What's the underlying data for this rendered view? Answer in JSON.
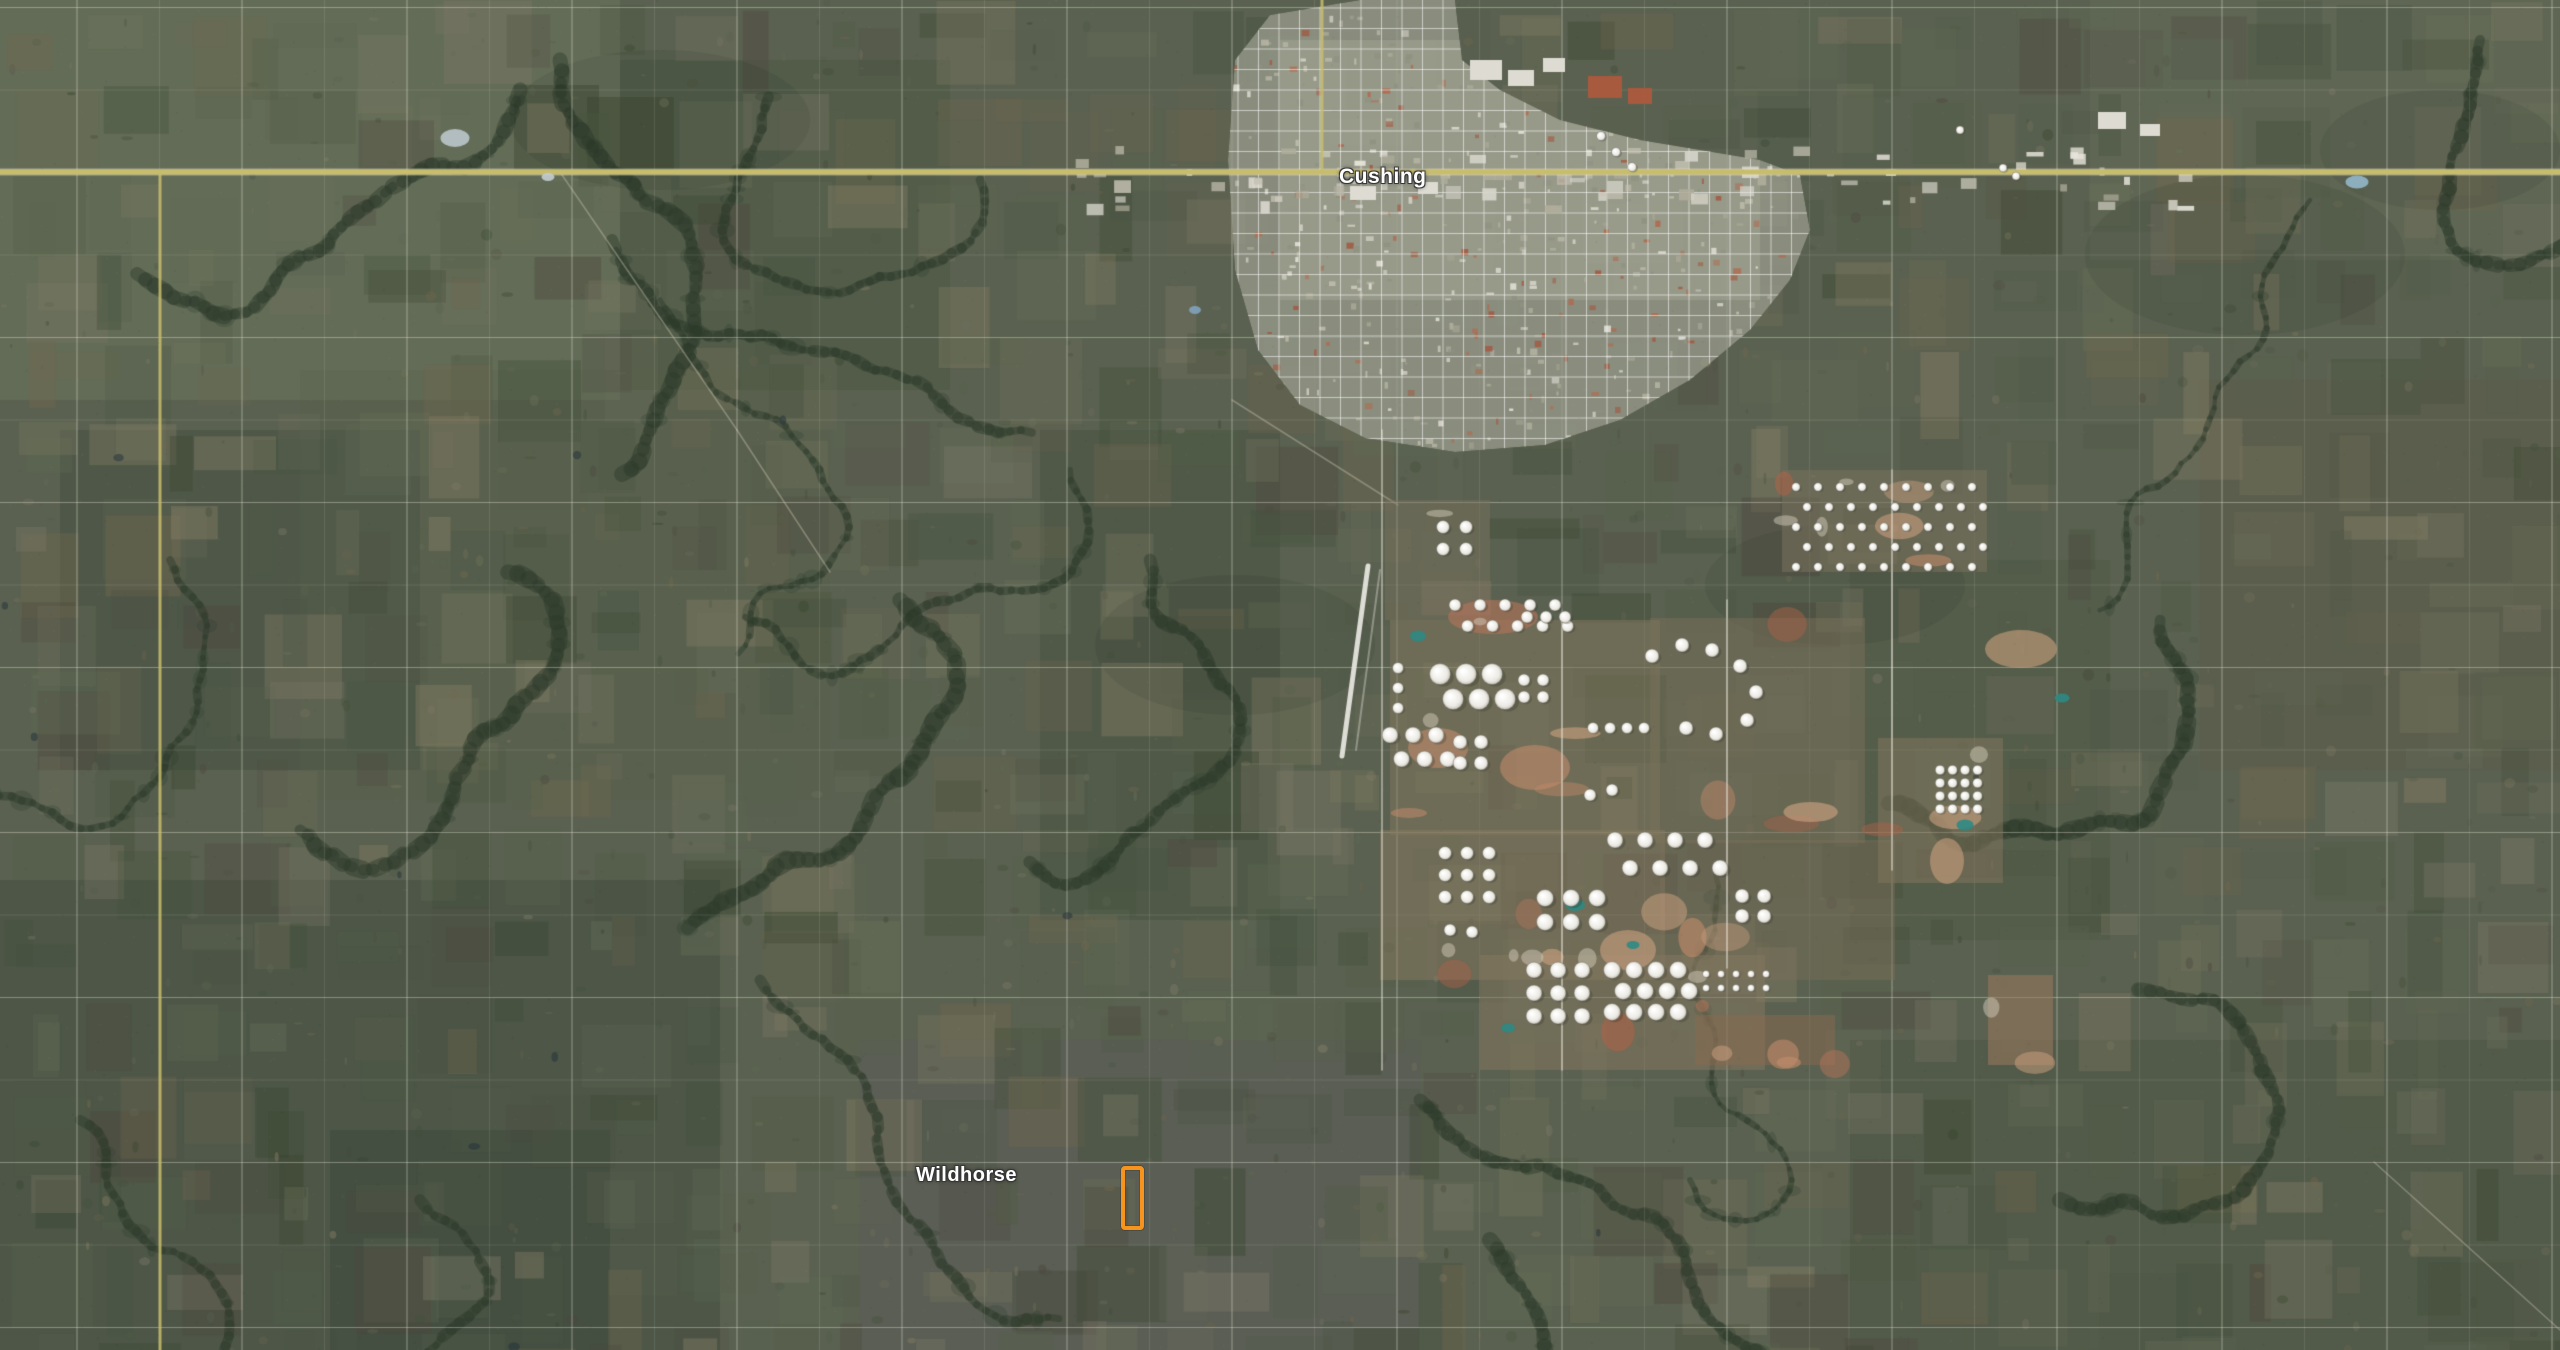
{
  "map": {
    "labels": [
      {
        "id": "cushing",
        "text": "Cushing",
        "x": 1339,
        "y": 165,
        "font_size": 21
      },
      {
        "id": "wildhorse",
        "text": "Wildhorse",
        "x": 916,
        "y": 1164,
        "font_size": 20
      }
    ],
    "marker": {
      "x": 1121,
      "y": 1166,
      "width": 15,
      "height": 56,
      "color": "#F7941D",
      "border_width": 4
    },
    "render": {
      "width": 2560,
      "height": 1350,
      "base_color": "#5a6150",
      "highway": {
        "y": 172,
        "color": "#c8bd6d",
        "edge_color": "rgba(245,240,210,0.45)",
        "width": 5
      },
      "yellow_roads": [
        [
          160,
          172,
          1350
        ],
        [
          1322,
          0,
          172
        ]
      ],
      "grid": {
        "spacing": 82.5,
        "x0": -5.5,
        "y0": 7.5,
        "color": "#eceade",
        "major_alpha": 0.38,
        "minor_alpha": 0.15
      },
      "palette": [
        "#4a5444",
        "#57614c",
        "#39452f",
        "#6a705a",
        "#77765f",
        "#8a8268",
        "#5e6854",
        "#4e473e",
        "#72684f",
        "#7e7a68",
        "#515c46",
        "#43503b"
      ],
      "macro_tints": [
        [
          0,
          0,
          620,
          400,
          "#6f7b5f",
          0.45
        ],
        [
          0,
          880,
          720,
          470,
          "#3e4a3b",
          0.45
        ],
        [
          60,
          430,
          360,
          340,
          "#3f4a3c",
          0.38
        ],
        [
          2090,
          0,
          470,
          260,
          "#6e7460",
          0.3
        ],
        [
          2200,
          380,
          360,
          390,
          "#5e5b47",
          0.32
        ],
        [
          1850,
          1040,
          710,
          310,
          "#47503f",
          0.4
        ],
        [
          860,
          1040,
          560,
          310,
          "#5a5660",
          0.28
        ],
        [
          1040,
          430,
          240,
          490,
          "#424d3c",
          0.38
        ],
        [
          300,
          370,
          530,
          430,
          "#55614b",
          0.28
        ],
        [
          1850,
          560,
          260,
          380,
          "#4a543f",
          0.3
        ],
        [
          620,
          60,
          330,
          330,
          "#45523d",
          0.35
        ],
        [
          330,
          1130,
          280,
          220,
          "#38443a",
          0.4
        ]
      ],
      "creek_color": "#2d3a2b",
      "creek_seeds": [
        [
          560,
          60,
          1.4
        ],
        [
          612,
          240,
          1.2
        ],
        [
          520,
          90,
          1.9
        ],
        [
          660,
          300,
          1.0
        ],
        [
          900,
          600,
          0.8
        ],
        [
          1070,
          470,
          1.5
        ],
        [
          1150,
          560,
          1.3
        ],
        [
          2310,
          200,
          2.2
        ],
        [
          2480,
          40,
          1.8
        ],
        [
          170,
          560,
          1.1
        ],
        [
          80,
          1120,
          0.5
        ],
        [
          420,
          1200,
          0.9
        ],
        [
          1420,
          1100,
          0.7
        ],
        [
          2060,
          1200,
          0.4
        ],
        [
          2160,
          620,
          1.6
        ],
        [
          1690,
          1180,
          1.1
        ],
        [
          760,
          980,
          1.0
        ],
        [
          300,
          830,
          0.6
        ],
        [
          980,
          180,
          1.2
        ],
        [
          1490,
          1240,
          0.9
        ]
      ],
      "cloud_shadows": [
        [
          2245,
          255,
          160,
          80
        ],
        [
          1835,
          585,
          130,
          60
        ],
        [
          2440,
          150,
          120,
          60
        ],
        [
          1235,
          645,
          140,
          70
        ],
        [
          660,
          120,
          150,
          70
        ]
      ],
      "diagonal_roads": [
        [
          560,
          172,
          737,
          430
        ],
        [
          737,
          430,
          830,
          572
        ],
        [
          1232,
          400,
          1398,
          505
        ],
        [
          2374,
          1162,
          2560,
          1330
        ]
      ],
      "town": {
        "polygon": [
          [
            1228,
            160
          ],
          [
            1235,
            60
          ],
          [
            1270,
            15
          ],
          [
            1360,
            0
          ],
          [
            1455,
            0
          ],
          [
            1462,
            60
          ],
          [
            1500,
            90
          ],
          [
            1560,
            120
          ],
          [
            1640,
            140
          ],
          [
            1700,
            150
          ],
          [
            1760,
            160
          ],
          [
            1800,
            175
          ],
          [
            1810,
            230
          ],
          [
            1790,
            280
          ],
          [
            1750,
            330
          ],
          [
            1690,
            380
          ],
          [
            1620,
            420
          ],
          [
            1545,
            445
          ],
          [
            1455,
            452
          ],
          [
            1365,
            438
          ],
          [
            1300,
            405
          ],
          [
            1258,
            350
          ],
          [
            1235,
            270
          ]
        ],
        "base_color": "#96998a",
        "core": [
          1280,
          40,
          480,
          260,
          "#a3a694"
        ],
        "street_color": "rgba(255,255,255,0.55)",
        "street_step": 20.5,
        "building_colors": [
          "#d8d6cc",
          "#c2bfae",
          "#a9a795",
          "#8f9181",
          "#b5b3a2",
          "#e4e2d8",
          "#a25840",
          "#b06a4e"
        ],
        "strip": [
          1075,
          146,
          1125,
          60
        ],
        "big_boxes": [
          [
            1470,
            60,
            32,
            20
          ],
          [
            1508,
            70,
            26,
            16
          ],
          [
            1543,
            58,
            22,
            14
          ],
          [
            2098,
            112,
            28,
            17
          ],
          [
            2140,
            124,
            20,
            12
          ],
          [
            1350,
            186,
            26,
            14
          ],
          [
            1418,
            182,
            20,
            12
          ]
        ],
        "red_complex": [
          [
            1588,
            76,
            34,
            22
          ],
          [
            1628,
            88,
            24,
            16
          ]
        ]
      },
      "runway": {
        "main": [
          1368,
          566,
          1342,
          756
        ],
        "taxi": [
          1380,
          570,
          1356,
          750
        ]
      },
      "farm_fields": [
        [
          1390,
          620,
          270,
          215,
          "#7f765d",
          0.55
        ],
        [
          1650,
          618,
          215,
          225,
          "#78705a",
          0.5
        ],
        [
          1380,
          830,
          285,
          150,
          "#877a60",
          0.5
        ],
        [
          1660,
          840,
          235,
          140,
          "#7b6f59",
          0.45
        ],
        [
          1480,
          955,
          285,
          115,
          "#857860",
          0.5
        ],
        [
          1878,
          738,
          125,
          145,
          "#84785e",
          0.5
        ],
        [
          1782,
          470,
          205,
          102,
          "#77705c",
          0.6
        ],
        [
          1385,
          500,
          105,
          120,
          "#7a725e",
          0.45
        ],
        [
          1695,
          1015,
          140,
          50,
          "#8a6a50",
          0.5
        ],
        [
          1988,
          975,
          65,
          90,
          "#9a7a5f",
          0.55
        ]
      ],
      "dirt_colors": [
        "#b5745a",
        "#c08a6a",
        "#ad6248",
        "#caa07f"
      ],
      "dirt_patches": [
        [
          1930,
          838,
          34,
          46
        ],
        [
          1985,
          630,
          72,
          38
        ],
        [
          1408,
          728,
          60,
          40
        ],
        [
          1448,
          600,
          90,
          34
        ],
        [
          1500,
          745,
          70,
          45
        ],
        [
          1600,
          930,
          56,
          40
        ]
      ],
      "farm_roads": {
        "v": [
          [
            1382,
            430,
            1070
          ],
          [
            1562,
            618,
            1070
          ],
          [
            1727,
            600,
            968
          ],
          [
            1892,
            470,
            870
          ]
        ],
        "h": [
          [
            1390,
            756,
            2230
          ],
          [
            1390,
            968,
            2110
          ],
          [
            1782,
            472,
            1985
          ],
          [
            1782,
            570,
            2100
          ]
        ]
      },
      "ponds_teal": [
        [
          1575,
          905,
          20,
          12
        ],
        [
          1965,
          825,
          17,
          11
        ],
        [
          1508,
          1028,
          14,
          9
        ],
        [
          1633,
          945,
          13,
          8
        ],
        [
          1418,
          636,
          16,
          11
        ],
        [
          2062,
          698,
          15,
          9
        ]
      ],
      "ponds_blue": [
        [
          1195,
          310,
          12,
          8,
          "#7fa3bd"
        ],
        [
          2357,
          182,
          23,
          13,
          "#93b7c9"
        ],
        [
          455,
          138,
          29,
          18,
          "#b9c6cb"
        ],
        [
          548,
          177,
          13,
          8,
          "#c4cdd1"
        ]
      ],
      "tank_clusters": [
        {
          "x": 1796,
          "y": 487,
          "cols": 9,
          "rows": 5,
          "dx": 22,
          "dy": 20,
          "r": 4.2,
          "stagger": true
        },
        {
          "x": 1455,
          "y": 605,
          "cols": 5,
          "rows": 2,
          "dx": 25,
          "dy": 21,
          "r": 6,
          "stagger": true
        },
        {
          "x": 1443,
          "y": 527,
          "cols": 2,
          "rows": 2,
          "dx": 23,
          "dy": 22,
          "r": 6.5,
          "stagger": false
        },
        {
          "x": 1440,
          "y": 674,
          "cols": 3,
          "rows": 2,
          "dx": 26,
          "dy": 25,
          "r": 10.5,
          "stagger": true
        },
        {
          "x": 1398,
          "y": 668,
          "cols": 1,
          "rows": 3,
          "dx": 0,
          "dy": 20,
          "r": 5.5,
          "stagger": false
        },
        {
          "x": 1390,
          "y": 735,
          "cols": 3,
          "rows": 2,
          "dx": 23,
          "dy": 24,
          "r": 8,
          "stagger": true
        },
        {
          "x": 1460,
          "y": 742,
          "cols": 2,
          "rows": 2,
          "dx": 21,
          "dy": 21,
          "r": 7,
          "stagger": false
        },
        {
          "x": 1524,
          "y": 680,
          "cols": 2,
          "rows": 2,
          "dx": 19,
          "dy": 17,
          "r": 6,
          "stagger": false
        },
        {
          "x": 1593,
          "y": 728,
          "cols": 4,
          "rows": 1,
          "dx": 17,
          "dy": 0,
          "r": 5.5,
          "stagger": false
        },
        {
          "x": 1527,
          "y": 617,
          "cols": 3,
          "rows": 1,
          "dx": 19,
          "dy": 0,
          "r": 6,
          "stagger": false
        },
        {
          "x": 1615,
          "y": 840,
          "cols": 4,
          "rows": 2,
          "dx": 30,
          "dy": 28,
          "r": 8,
          "stagger": true
        },
        {
          "x": 1445,
          "y": 853,
          "cols": 3,
          "rows": 3,
          "dx": 22,
          "dy": 22,
          "r": 6.5,
          "stagger": false
        },
        {
          "x": 1545,
          "y": 898,
          "cols": 3,
          "rows": 2,
          "dx": 26,
          "dy": 24,
          "r": 8.5,
          "stagger": false
        },
        {
          "x": 1940,
          "y": 770,
          "cols": 4,
          "rows": 4,
          "dx": 12.5,
          "dy": 13,
          "r": 4.8,
          "stagger": false
        },
        {
          "x": 1534,
          "y": 970,
          "cols": 3,
          "rows": 3,
          "dx": 24,
          "dy": 23,
          "r": 8,
          "stagger": false
        },
        {
          "x": 1612,
          "y": 970,
          "cols": 4,
          "rows": 3,
          "dx": 22,
          "dy": 21,
          "r": 8.5,
          "stagger": true
        },
        {
          "x": 1706,
          "y": 974,
          "cols": 5,
          "rows": 2,
          "dx": 15,
          "dy": 14,
          "r": 3.5,
          "stagger": false
        },
        {
          "x": 1742,
          "y": 896,
          "cols": 2,
          "rows": 2,
          "dx": 22,
          "dy": 20,
          "r": 7,
          "stagger": false
        }
      ],
      "tank_singles": [
        [
          1652,
          656,
          7
        ],
        [
          1682,
          645,
          7
        ],
        [
          1712,
          650,
          7
        ],
        [
          1740,
          666,
          7
        ],
        [
          1756,
          692,
          7
        ],
        [
          1747,
          720,
          7
        ],
        [
          1716,
          734,
          7
        ],
        [
          1686,
          728,
          7
        ],
        [
          1601,
          136,
          4.5
        ],
        [
          1616,
          152,
          4.5
        ],
        [
          1632,
          167,
          4.5
        ],
        [
          1450,
          930,
          6
        ],
        [
          1472,
          932,
          6
        ],
        [
          1590,
          795,
          6
        ],
        [
          1612,
          790,
          6
        ],
        [
          2003,
          168,
          4
        ],
        [
          2016,
          176,
          4
        ],
        [
          1960,
          130,
          4
        ]
      ]
    }
  }
}
